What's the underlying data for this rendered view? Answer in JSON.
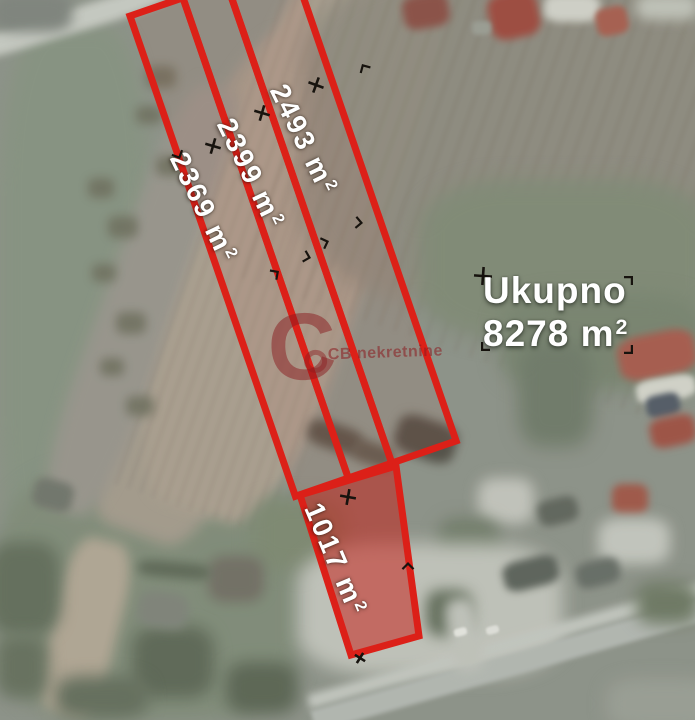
{
  "map": {
    "parcels": [
      {
        "label": "2369 m²",
        "value": "2369 m",
        "sup": "2"
      },
      {
        "label": "2399 m²",
        "value": "2399 m",
        "sup": "2"
      },
      {
        "label": "2493 m²",
        "value": "2493 m",
        "sup": "2"
      },
      {
        "label": "1017 m²",
        "value": "1017 m",
        "sup": "2"
      }
    ],
    "total": {
      "label": "Ukupno",
      "value": "8278 m",
      "sup": "2",
      "full": "8278 m²"
    },
    "watermark": {
      "logo": "C",
      "name": "CB nekretnine"
    }
  },
  "colors": {
    "parcel_outline": "#dc2018",
    "parcel_fill": "rgba(198,28,22,0.52)",
    "label_text": "#ffffff",
    "watermark": "#8b1c20",
    "marker": "#17130e"
  }
}
